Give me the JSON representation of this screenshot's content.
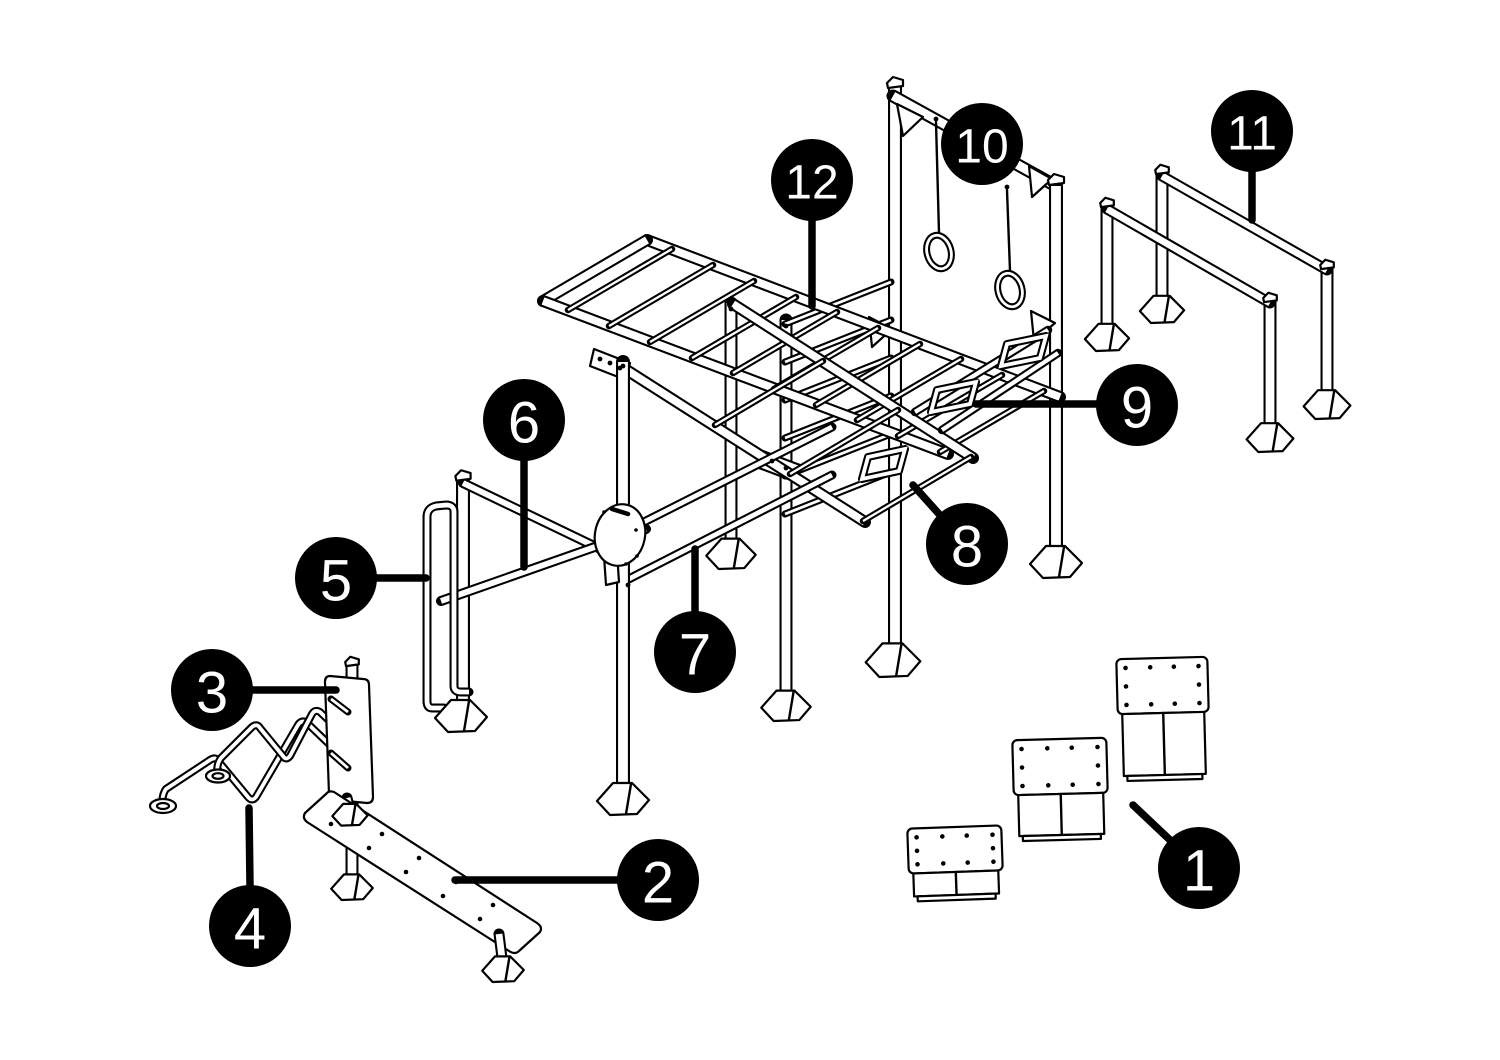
{
  "diagram": {
    "background": "#ffffff",
    "line_color": "#000000",
    "callout_fill": "#000000",
    "callout_text_color": "#ffffff",
    "callouts": [
      {
        "label": "1",
        "cx": 1199,
        "cy": 868,
        "r": 41,
        "leader": [
          [
            1133,
            805
          ],
          [
            1170,
            840
          ]
        ]
      },
      {
        "label": "2",
        "cx": 658,
        "cy": 880,
        "r": 41,
        "leader": [
          [
            455,
            880
          ],
          [
            618,
            880
          ]
        ]
      },
      {
        "label": "3",
        "cx": 212,
        "cy": 690,
        "r": 41,
        "leader": [
          [
            252,
            690
          ],
          [
            336,
            690
          ]
        ]
      },
      {
        "label": "4",
        "cx": 250,
        "cy": 926,
        "r": 41,
        "leader": [
          [
            249,
            808
          ],
          [
            250,
            886
          ]
        ]
      },
      {
        "label": "5",
        "cx": 336,
        "cy": 578,
        "r": 41,
        "leader": [
          [
            376,
            578
          ],
          [
            426,
            578
          ]
        ]
      },
      {
        "label": "6",
        "cx": 524,
        "cy": 420,
        "r": 41,
        "leader": [
          [
            524,
            460
          ],
          [
            524,
            567
          ]
        ]
      },
      {
        "label": "7",
        "cx": 695,
        "cy": 652,
        "r": 41,
        "leader": [
          [
            695,
            549
          ],
          [
            695,
            612
          ]
        ]
      },
      {
        "label": "8",
        "cx": 967,
        "cy": 544,
        "r": 41,
        "leader": [
          [
            913,
            485
          ],
          [
            939,
            514
          ]
        ]
      },
      {
        "label": "9",
        "cx": 1137,
        "cy": 405,
        "r": 41,
        "leader": [
          [
            976,
            404
          ],
          [
            1096,
            404
          ]
        ]
      },
      {
        "label": "10",
        "cx": 982,
        "cy": 144,
        "r": 41,
        "leader": null
      },
      {
        "label": "11",
        "cx": 1252,
        "cy": 131,
        "r": 41,
        "leader": [
          [
            1252,
            171
          ],
          [
            1252,
            220
          ]
        ]
      },
      {
        "label": "12",
        "cx": 812,
        "cy": 180,
        "r": 41,
        "leader": [
          [
            812,
            220
          ],
          [
            812,
            306
          ]
        ]
      }
    ],
    "feet": [
      [
        461,
        712,
        1
      ],
      [
        623,
        795,
        1
      ],
      [
        731,
        550,
        0.95
      ],
      [
        786,
        702,
        0.95
      ],
      [
        893,
        656,
        1.05
      ],
      [
        1056,
        558,
        1
      ],
      [
        1107,
        334,
        0.85
      ],
      [
        1162,
        306,
        0.85
      ],
      [
        1270,
        434,
        0.9
      ],
      [
        1327,
        401,
        0.9
      ],
      [
        352,
        884,
        0.8
      ],
      [
        350,
        812,
        0.68
      ],
      [
        503,
        966,
        0.8
      ]
    ],
    "caps": [
      [
        895,
        82,
        1
      ],
      [
        1056,
        179,
        1
      ],
      [
        1107,
        202,
        0.85
      ],
      [
        1162,
        169,
        0.85
      ],
      [
        1270,
        297,
        0.85
      ],
      [
        1327,
        264,
        0.85
      ],
      [
        463,
        475,
        0.95
      ],
      [
        352,
        661,
        0.85
      ]
    ],
    "ladder_rungs": [
      [
        672,
        249,
        568,
        310
      ],
      [
        713,
        265,
        609,
        326
      ],
      [
        754,
        281,
        650,
        342
      ],
      [
        796,
        297,
        692,
        358
      ],
      [
        837,
        312,
        733,
        373
      ],
      [
        878,
        328,
        774,
        389
      ],
      [
        920,
        344,
        816,
        405
      ],
      [
        961,
        359,
        857,
        420
      ],
      [
        1002,
        375,
        898,
        436
      ],
      [
        1044,
        391,
        940,
        452
      ]
    ],
    "stall_rungs": [
      [
        891,
        282,
        785,
        324
      ],
      [
        891,
        320,
        785,
        362
      ],
      [
        891,
        358,
        785,
        400
      ],
      [
        891,
        396,
        785,
        438
      ],
      [
        891,
        434,
        785,
        476
      ],
      [
        891,
        472,
        785,
        514
      ]
    ],
    "incline_rungs": [
      [
        823,
        361,
        715,
        425
      ],
      [
        898,
        410,
        790,
        474
      ],
      [
        971,
        457,
        863,
        521
      ]
    ],
    "blocks": [
      {
        "x": 1117,
        "y": 658,
        "w": 91,
        "ph": 55,
        "bh": 62,
        "tilt": -1.5
      },
      {
        "x": 1013,
        "y": 739,
        "w": 94,
        "ph": 55,
        "bh": 41,
        "tilt": -1.5
      },
      {
        "x": 908,
        "y": 827,
        "w": 94,
        "ph": 45,
        "bh": 23,
        "tilt": -2
      }
    ],
    "bench_screws": [
      [
        344,
        810
      ],
      [
        382,
        834
      ],
      [
        419,
        858
      ],
      [
        456,
        882
      ],
      [
        493,
        905
      ],
      [
        331,
        824
      ],
      [
        369,
        848
      ],
      [
        406,
        872
      ],
      [
        443,
        896
      ],
      [
        480,
        919
      ]
    ],
    "disc_dots": [
      [
        604,
        512
      ],
      [
        636,
        530
      ],
      [
        637,
        556
      ],
      [
        626,
        564
      ]
    ],
    "plate_bolts": [
      [
        600,
        359
      ],
      [
        610,
        363
      ],
      [
        620,
        368
      ],
      [
        772,
        461
      ],
      [
        786,
        468
      ],
      [
        628,
        585
      ],
      [
        936,
        119
      ],
      [
        1007,
        187
      ],
      [
        623,
        366
      ],
      [
        731,
        309
      ],
      [
        786,
        326
      ]
    ]
  }
}
